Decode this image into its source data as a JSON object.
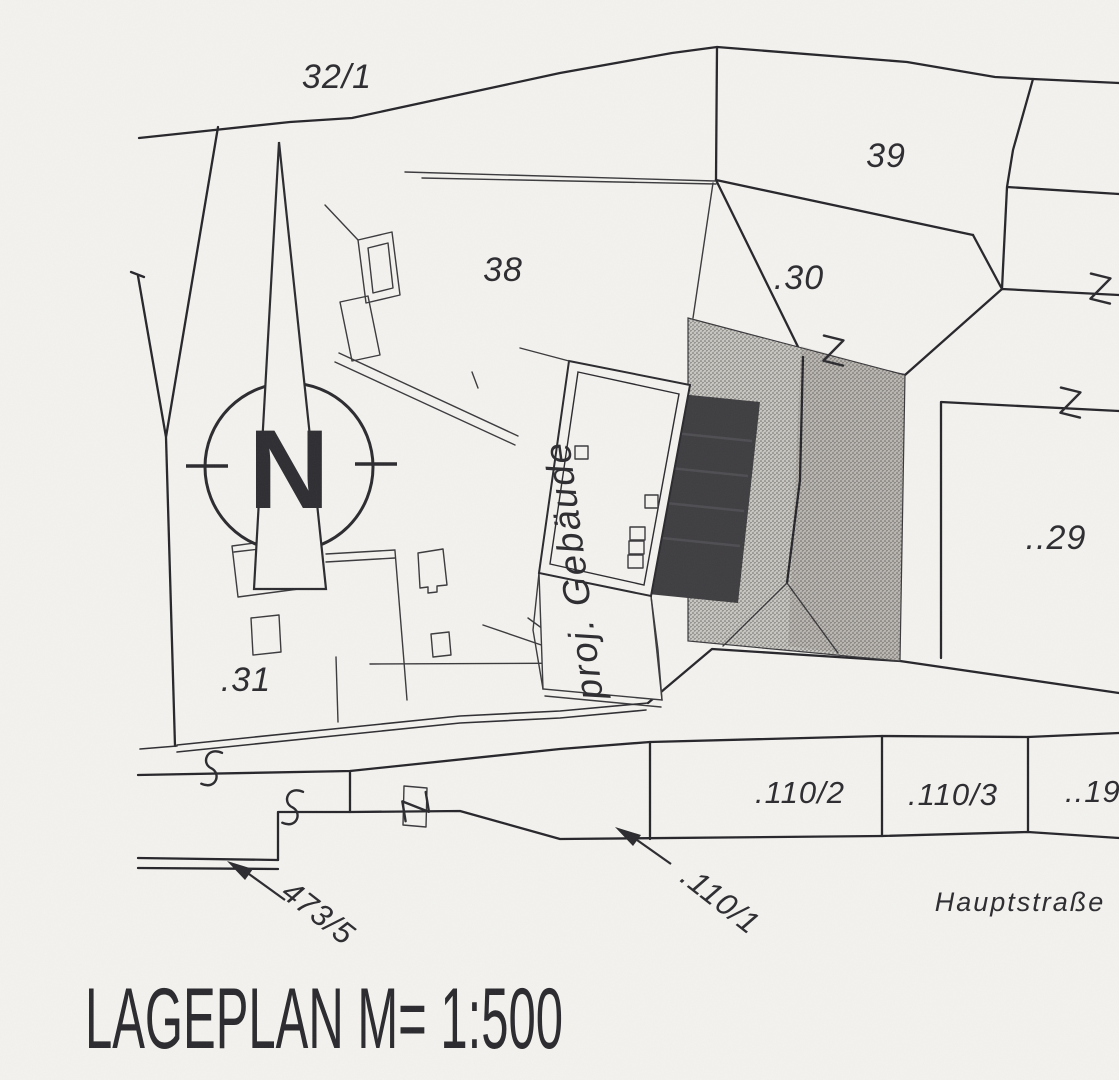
{
  "page": {
    "background": "#f3f2ee",
    "ink": "#2b2a2c"
  },
  "title_block": {
    "text": "LAGEPLAN  M= 1:500"
  },
  "compass": {
    "north_letter": "N"
  },
  "labels": {
    "parcel_32_1": "32/1",
    "parcel_39": "39",
    "parcel_38": "38",
    "parcel_30": ".30",
    "parcel_29": "..29",
    "parcel_31": ".31",
    "parcel_110_2": ".110/2",
    "parcel_110_3": ".110/3",
    "parcel_19": "..19",
    "parcel_473_5": "473/5",
    "parcel_110_1": ".110/1",
    "street_name": "Hauptstraße",
    "planned_building": "proj. Gebäude"
  },
  "map_symbols": {
    "s_connection_mark_glyph": "S",
    "z_connection_mark_glyph": "Z",
    "s_mark_count": 2,
    "z_mark_count": 4,
    "north_arrow": "compass-circle-with-needle"
  },
  "colors": {
    "paper": "#f3f2ee",
    "existing_building_gray": "#b5b3ae",
    "solid_building_fill": "#3e3d40",
    "line_ink": "#26252a"
  }
}
